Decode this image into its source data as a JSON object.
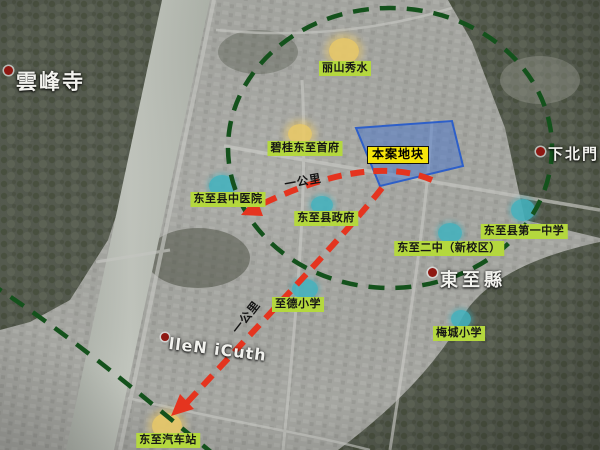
{
  "map": {
    "landmarks": [
      {
        "label": "丽山秀水",
        "marker": "yellow"
      },
      {
        "label": "碧桂东至首府",
        "marker": "yellow"
      },
      {
        "label": "东至县中医院",
        "marker": "teal"
      },
      {
        "label": "东至县政府",
        "marker": "teal"
      },
      {
        "label": "东至二中（新校区）",
        "marker": "teal"
      },
      {
        "label": "东至县第一中学",
        "marker": "teal"
      },
      {
        "label": "至德小学",
        "marker": "teal"
      },
      {
        "label": "梅城小学",
        "marker": "teal"
      },
      {
        "label": "东至汽车站",
        "marker": "yellow"
      }
    ],
    "site": {
      "label": "本案地块"
    },
    "place_names": [
      {
        "text": "雲峰寺"
      },
      {
        "text": "下北門"
      },
      {
        "text": "東至縣"
      },
      {
        "text": "lleN iCuth"
      }
    ],
    "distance_labels": [
      {
        "text": "一公里"
      },
      {
        "text": "一公里"
      }
    ],
    "colors": {
      "landmark_label_bg": "#b4d83e",
      "site_label_bg": "#f6e50a",
      "site_area_fill": "#4a76cd",
      "radius_circle_stroke": "#14521c",
      "route_arrow": "#e5341f",
      "marker_yellow": "#e9c967",
      "marker_teal": "#42b2be"
    }
  }
}
